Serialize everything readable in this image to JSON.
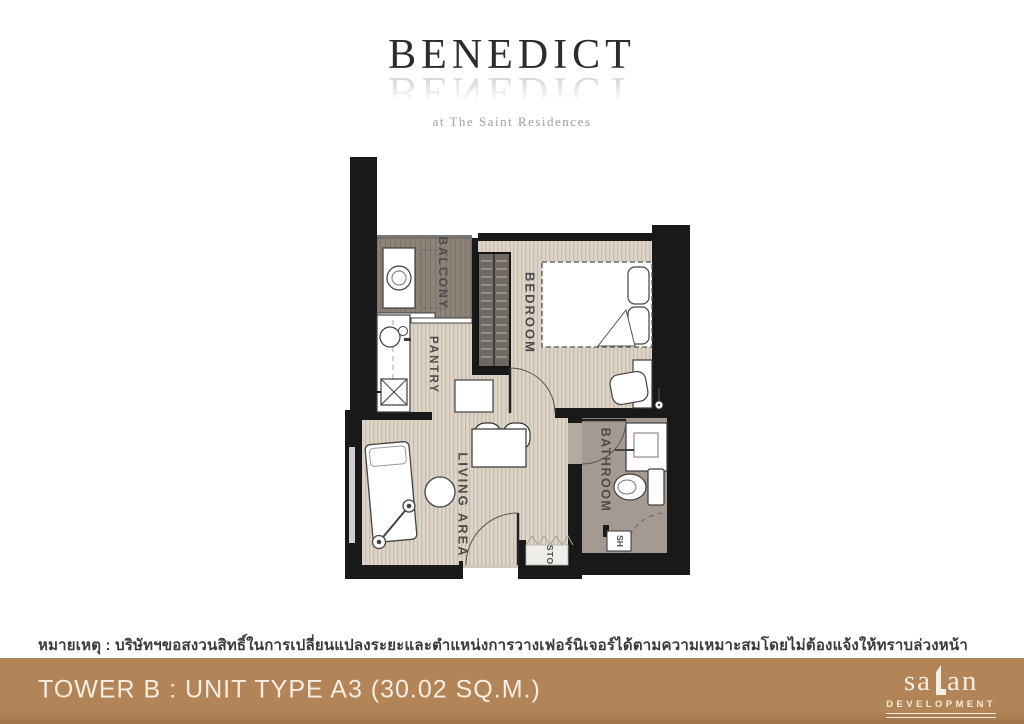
{
  "brand": {
    "title": "BENEDICT",
    "reflection": "BENEDICT",
    "tagline": "at The Saint Residences"
  },
  "plan": {
    "labels": {
      "balcony": "BALCONY",
      "pantry": "PANTRY",
      "bedroom": "BEDROOM",
      "living_area": "LIVING AREA",
      "bathroom": "BATHROOM",
      "storage": "STO",
      "shower": "SH"
    }
  },
  "note": {
    "text": "หมายเหตุ : บริษัทฯขอสงวนสิทธิ์ในการเปลี่ยนแปลงระยะและตำแหน่งการวางเฟอร์นิเจอร์ได้ตามความเหมาะสมโดยไม่ต้องแจ้งให้ทราบล่วงหน้า"
  },
  "footer": {
    "unit_info": "TOWER B : UNIT TYPE A3 (30.02 SQ.M.)",
    "logo": {
      "pre": "sa",
      "post": "an",
      "subtext": "DEVELOPMENT"
    }
  },
  "colors": {
    "footer_bg": "#b28457",
    "footer_bg_dark": "#a0764a",
    "cream": "#f6eee1",
    "wall": "#191919",
    "wood_floor": "#ded5c8",
    "balcony_floor": "#8d8277",
    "bathroom_floor": "#a49a92"
  }
}
